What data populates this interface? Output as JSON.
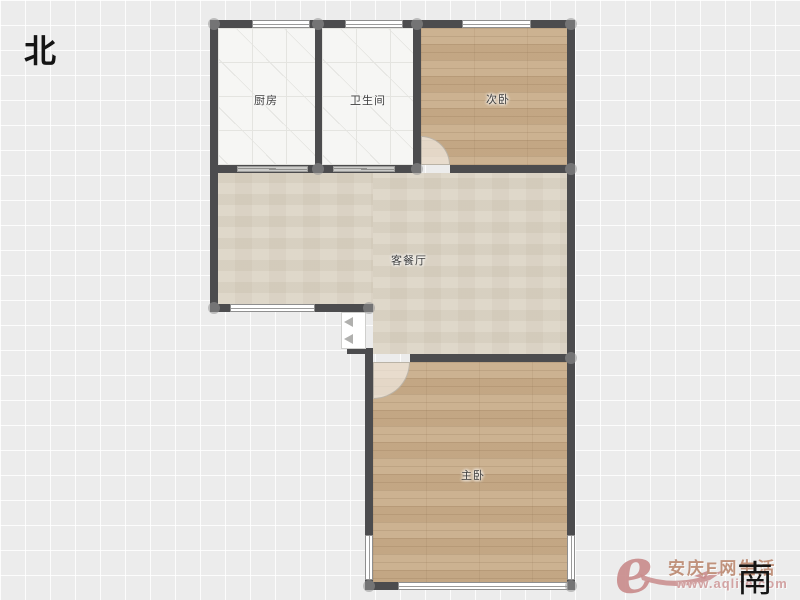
{
  "compass": {
    "north": "北",
    "south": "南"
  },
  "rooms": {
    "kitchen": {
      "label": "厨房"
    },
    "bathroom": {
      "label": "卫生间"
    },
    "bedroom2": {
      "label": "次卧"
    },
    "living": {
      "label": "客餐厅"
    },
    "master": {
      "label": "主卧"
    }
  },
  "watermark": {
    "logo": "e",
    "title": "安庆E网生活",
    "url": "www.aqlife.com",
    "color": "#c9908d"
  },
  "colors": {
    "wall": "#4c4c4e",
    "tile_floor": "#f6f6f4",
    "wood_floor": "#c9ad8a",
    "living_floor": "#dcd4c5",
    "background": "#ececec"
  }
}
